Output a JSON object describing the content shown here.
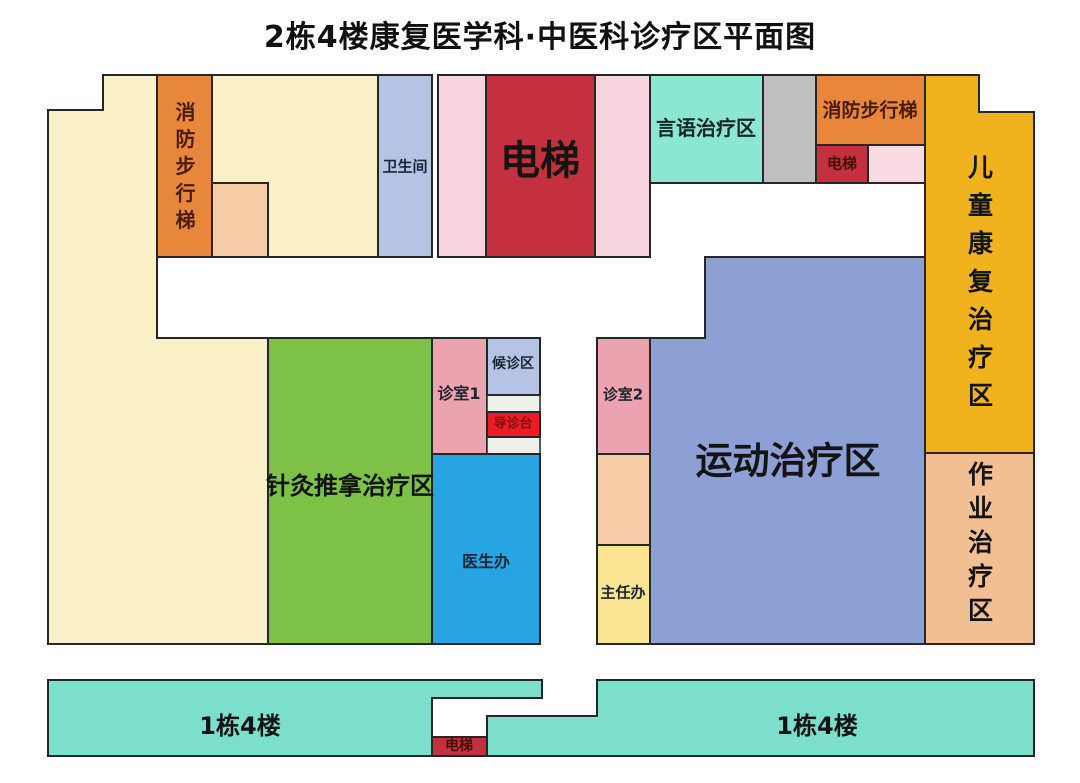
{
  "title": "2栋4楼康复医学科·中医科诊疗区平面图",
  "regions": {
    "fire_stairs_left": {
      "label": "消防步行梯"
    },
    "restroom": {
      "label": "卫生间"
    },
    "elevator_main": {
      "label": "电梯"
    },
    "speech_therapy": {
      "label": "言语治疗区"
    },
    "fire_stairs_top_right": {
      "label": "消防步行梯"
    },
    "elevator_top_right": {
      "label": "电梯"
    },
    "children_rehab": {
      "label": "儿童康复治疗区"
    },
    "occupational_therapy": {
      "label": "作业治疗区"
    },
    "exercise_therapy": {
      "label": "运动治疗区"
    },
    "acupuncture_massage": {
      "label": "针灸推拿治疗区"
    },
    "consult_room_1": {
      "label": "诊室1"
    },
    "waiting_area": {
      "label": "候诊区"
    },
    "guidance_desk": {
      "label": "导诊台"
    },
    "doctor_office": {
      "label": "医生办"
    },
    "consult_room_2": {
      "label": "诊室2"
    },
    "director_office": {
      "label": "主任办"
    },
    "building1_left": {
      "label": "1栋4楼"
    },
    "building1_right": {
      "label": "1栋4楼"
    },
    "elevator_bottom": {
      "label": "电梯"
    }
  },
  "palette": {
    "cream": "#FAF0C8",
    "orange": "#E8873C",
    "peach": "#F5CCA6",
    "periwinkle_light": "#B5C4E4",
    "pink_strip": "#F8D4DF",
    "crimson": "#C5303E",
    "bright_red": "#EE1B24",
    "teal_top": "#8BE7D2",
    "teal_bottom": "#7CDFCB",
    "gray": "#BFBFBF",
    "gold": "#F0B31E",
    "sandy": "#F2BF93",
    "green": "#7DC247",
    "periwinkle_big": "#8CA0D6",
    "pink_room": "#EAA3AF",
    "blue": "#27A5E2",
    "light_yellow": "#FBE394",
    "column_bg": "#EDF1EA",
    "border": "#262626",
    "title_text": "#111111"
  }
}
